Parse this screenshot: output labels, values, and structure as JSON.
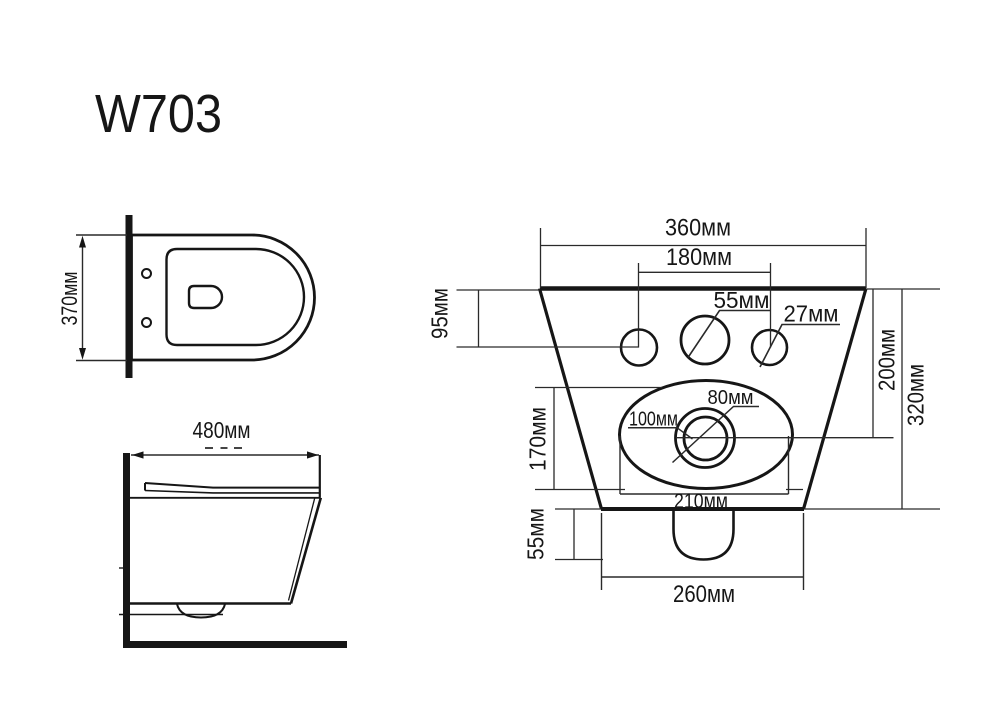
{
  "title": "W703",
  "colors": {
    "ink": "#161616",
    "background": "#ffffff"
  },
  "top_view": {
    "depth": "370мм"
  },
  "side_view": {
    "length": "480мм"
  },
  "rear_view": {
    "width_top": "360мм",
    "bolt_spacing": "180мм",
    "inlet_hole_diameter": "55мм",
    "bolt_hole_diameter": "27мм",
    "holes_offset": "95мм",
    "recess_height": "170мм",
    "outlet_outer_diameter": "100мм",
    "outlet_inner_diameter": "80мм",
    "recess_width": "210мм",
    "top_to_outlet_center": "200мм",
    "overall_height": "320мм",
    "drain_depth": "55мм",
    "width_bottom": "260мм"
  }
}
